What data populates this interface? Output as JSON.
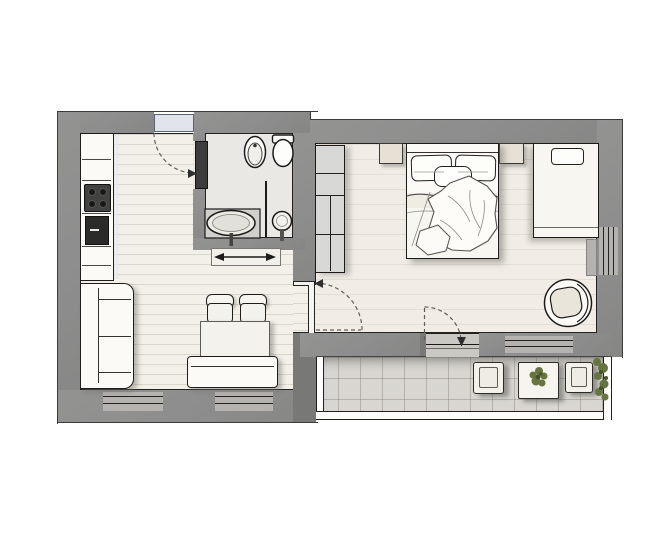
{
  "plan": {
    "title": "Studio apartment floor plan",
    "rooms": [
      {
        "id": "kitchen-living",
        "label": "Kitchen / Living Room",
        "furniture": [
          "kitchen counter",
          "cooktop",
          "oven",
          "sofa",
          "dining table",
          "chair",
          "chair",
          "bench",
          "console"
        ]
      },
      {
        "id": "hall",
        "label": "Entrance Hall",
        "furniture": [
          "entrance door"
        ]
      },
      {
        "id": "bathroom",
        "label": "Bathroom",
        "furniture": [
          "bidet",
          "wall-hung toilet",
          "washbasin counter",
          "pedestal basin",
          "bathroom door"
        ]
      },
      {
        "id": "bedroom",
        "label": "Bedroom",
        "furniture": [
          "double bed",
          "nightstand",
          "nightstand",
          "wardrobe shelving",
          "daybed",
          "swivel chair",
          "radiator"
        ]
      },
      {
        "id": "balcony",
        "label": "Balcony",
        "furniture": [
          "lounge chair",
          "side table",
          "potted plant",
          "lounge chair",
          "shrub"
        ]
      }
    ],
    "doors": [
      {
        "id": "entrance-door",
        "type": "swing"
      },
      {
        "id": "bathroom-door",
        "type": "swing"
      },
      {
        "id": "bedroom-door",
        "type": "swing"
      },
      {
        "id": "balcony-door",
        "type": "swing"
      }
    ],
    "windows": [
      {
        "id": "living-window-1"
      },
      {
        "id": "living-window-2"
      },
      {
        "id": "bedroom-window-south"
      },
      {
        "id": "bedroom-window-east"
      }
    ],
    "colors": {
      "wall": "#8d8d8d",
      "wall-dark": "#787876",
      "floor-wood": "#f3f0e9",
      "floor-bedroom": "#f1ede6",
      "floor-bath": "#eae8e4",
      "balcony-tile": "#d8d6d0",
      "furniture": "#fbfaf6",
      "beige": "#e7e1d5",
      "charcoal": "#3c3c3a",
      "door-leaf": "#e1e5eb",
      "window": "#b5b3af",
      "closet": "#d8d8d6",
      "plant": "#66743f",
      "plant-dark": "#45512e",
      "shadow": "rgba(110,108,102,0.45)"
    }
  }
}
